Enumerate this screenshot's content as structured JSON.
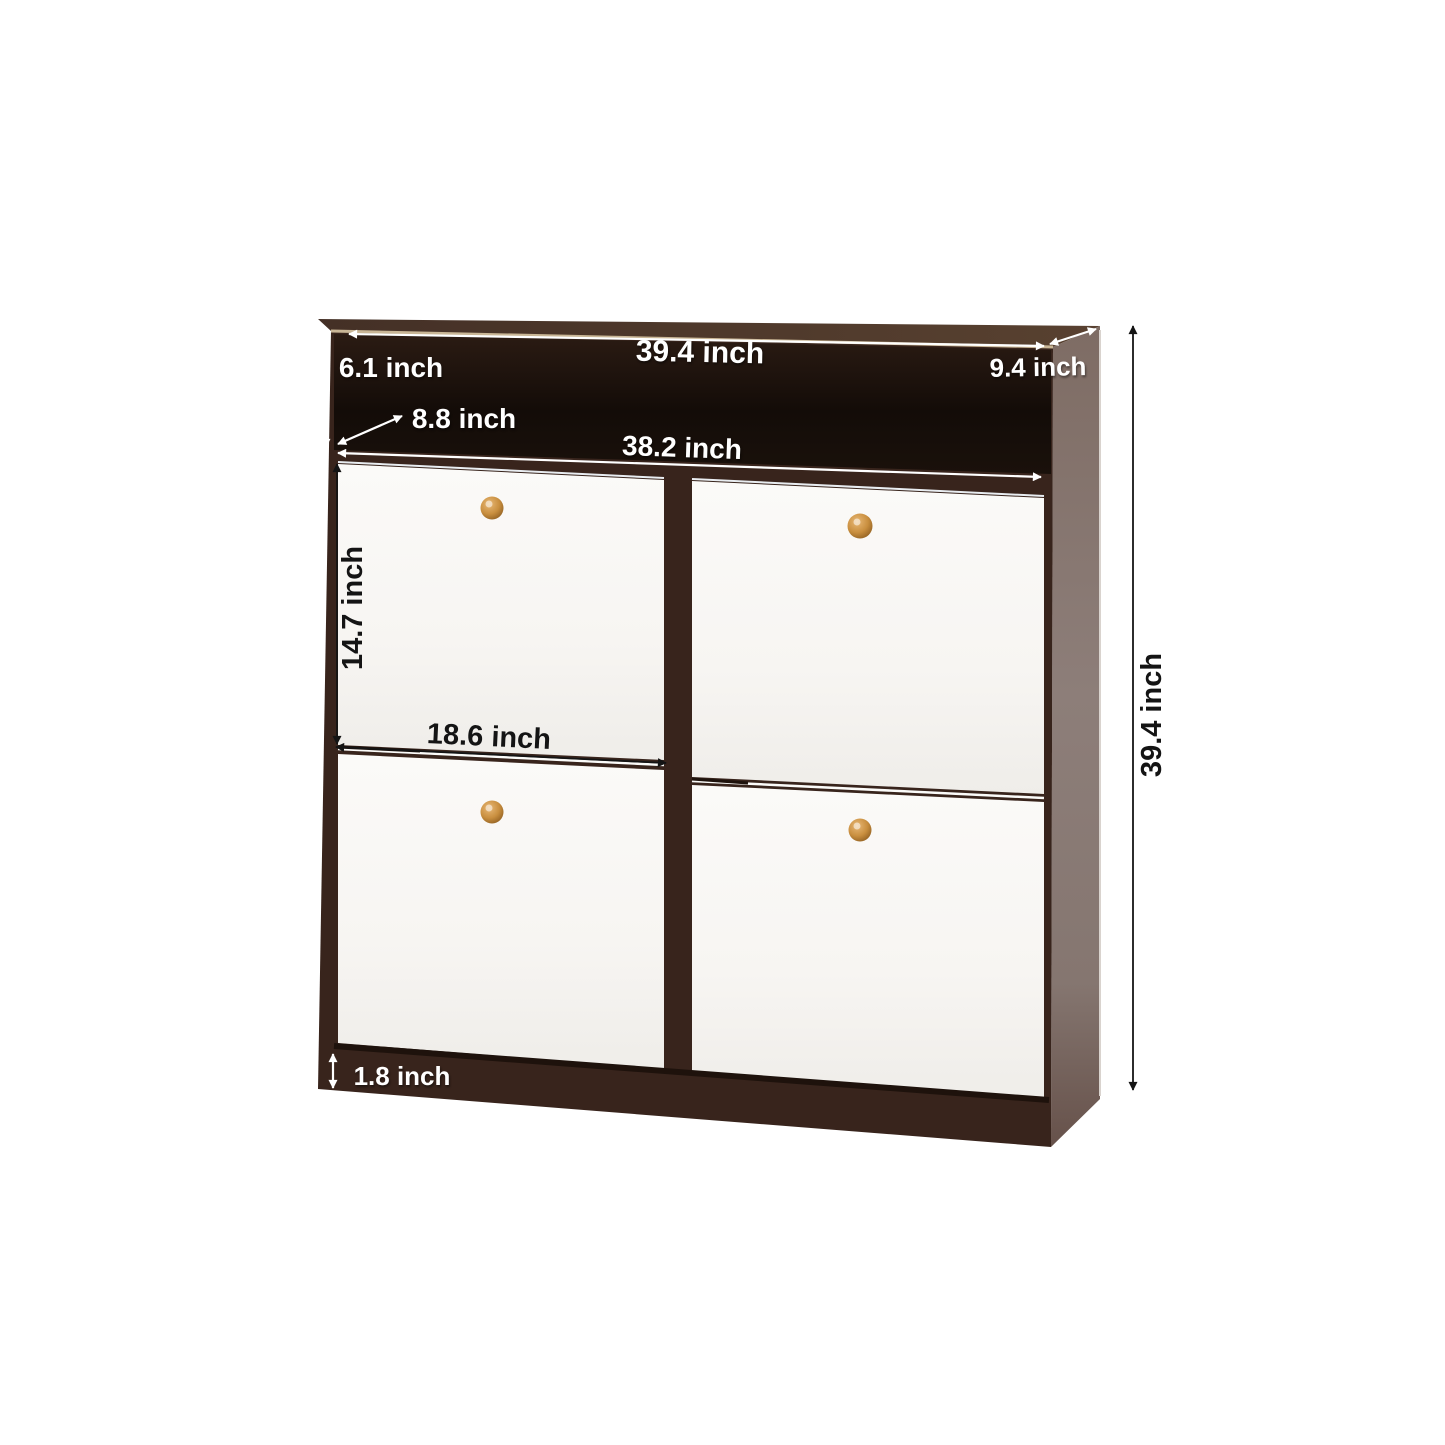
{
  "diagram": {
    "type": "product-dimension-diagram",
    "product": "4-door flip-down shoe storage cabinet",
    "unit": "inch",
    "dimensions": {
      "top_width": {
        "label": "39.4 inch",
        "value": 39.4,
        "text_color": "white",
        "orientation": "horizontal"
      },
      "depth": {
        "label": "9.4 inch",
        "value": 9.4,
        "text_color": "white",
        "orientation": "horizontal"
      },
      "open_shelf_height": {
        "label": "6.1 inch",
        "value": 6.1,
        "text_color": "white",
        "orientation": "horizontal"
      },
      "open_shelf_depth": {
        "label": "8.8 inch",
        "value": 8.8,
        "text_color": "white",
        "orientation": "horizontal"
      },
      "inner_width": {
        "label": "38.2 inch",
        "value": 38.2,
        "text_color": "white",
        "orientation": "horizontal"
      },
      "door_height": {
        "label": "14.7 inch",
        "value": 14.7,
        "text_color": "black",
        "orientation": "vertical"
      },
      "door_width": {
        "label": "18.6 inch",
        "value": 18.6,
        "text_color": "black",
        "orientation": "horizontal"
      },
      "base_height": {
        "label": "1.8 inch",
        "value": 1.8,
        "text_color": "white",
        "orientation": "horizontal"
      },
      "total_height": {
        "label": "39.4 inch",
        "value": 39.4,
        "text_color": "black",
        "orientation": "vertical"
      }
    },
    "colors": {
      "background": "#ffffff",
      "frame": "#38241c",
      "frame_shadow": "#1e120c",
      "top_left": "#443026",
      "top_right": "#584130",
      "top_edge": "#c9b696",
      "shelf_top": "#2b1b13",
      "shelf_bottom": "#130c08",
      "door_light": "#fbfaf8",
      "door_dark": "#efede9",
      "side_top": "#7e6c64",
      "side_mid": "#8d7e79",
      "side_bottom": "#66514a",
      "side_edge": "#d9d3ce",
      "knob_light": "#e8b876",
      "knob_mid": "#c98f3f",
      "knob_rim": "#8a5a1e",
      "dim_white": "#ffffff",
      "dim_black": "#141414"
    }
  }
}
